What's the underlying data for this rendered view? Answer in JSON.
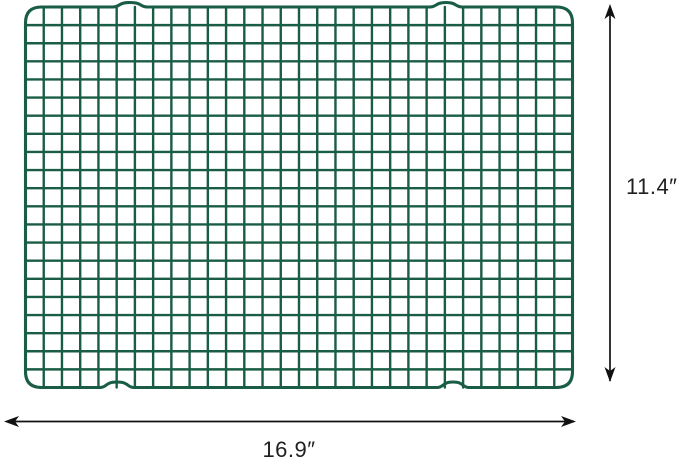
{
  "diagram": {
    "kind": "product-dimension-diagram",
    "background_color": "#ffffff",
    "rack": {
      "item": "wire cooling rack (grid) viewed from above",
      "wire_color": "#1a5d45",
      "grid_columns": 30,
      "grid_rows": 21
    },
    "dimensions": {
      "height_label": "11.4″",
      "width_label": "16.9″",
      "arrow_color": "#111111",
      "label_color": "#1f1f1f"
    }
  }
}
